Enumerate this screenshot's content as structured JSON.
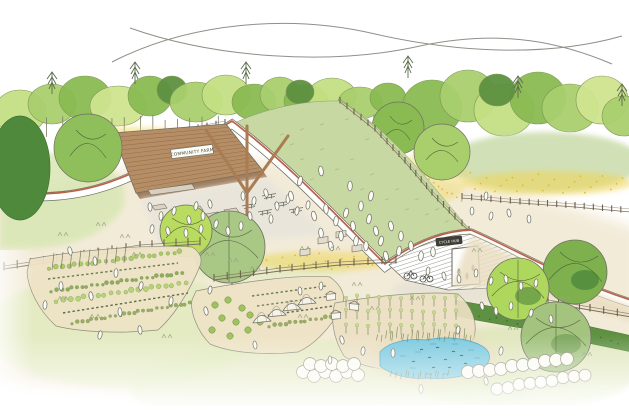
{
  "scene": {
    "title": "Hand-drawn watercolour concept sketch of a community farm park with a sweeping green-roofed building",
    "signs": {
      "barn": "COMMUNITY FARM",
      "cycle_hub": "CYCLE HUB"
    },
    "features": [
      "two crossing swoosh lines in the sky",
      "woodland treeline with conifers",
      "curved green-roof barn with timber soffit and market stalls",
      "white roof fascia with terracotta stripe",
      "timber support mast",
      "grass roof slope with visitors",
      "cycle hub under the roof dip",
      "post-and-rail fences",
      "yellow wildflower bands",
      "vegetable plots with crop rows and bean poles",
      "polytunnels",
      "beehives",
      "orchard saplings and shrubs",
      "duck pond with reeds",
      "clipped hedges",
      "round broadleaf trees",
      "visitor figures"
    ],
    "palette": {
      "paper": "#ffffff",
      "ink": "#6f6f63",
      "tree_greens": [
        "#c4e083",
        "#a9cf6d",
        "#8abb52",
        "#cfe490",
        "#5d9140",
        "#4f8a3c"
      ],
      "roof_grass": "#c7d8a2",
      "timber": "#b68e66",
      "fascia_stripe": "#b45a3d",
      "ground_cream": "#f1e9d4",
      "plot_tan": "#eee3c6",
      "wildflower_yellow": "#f0d455",
      "hedge_green": "#5f9142",
      "pond_blue": "#7ccadf"
    }
  }
}
